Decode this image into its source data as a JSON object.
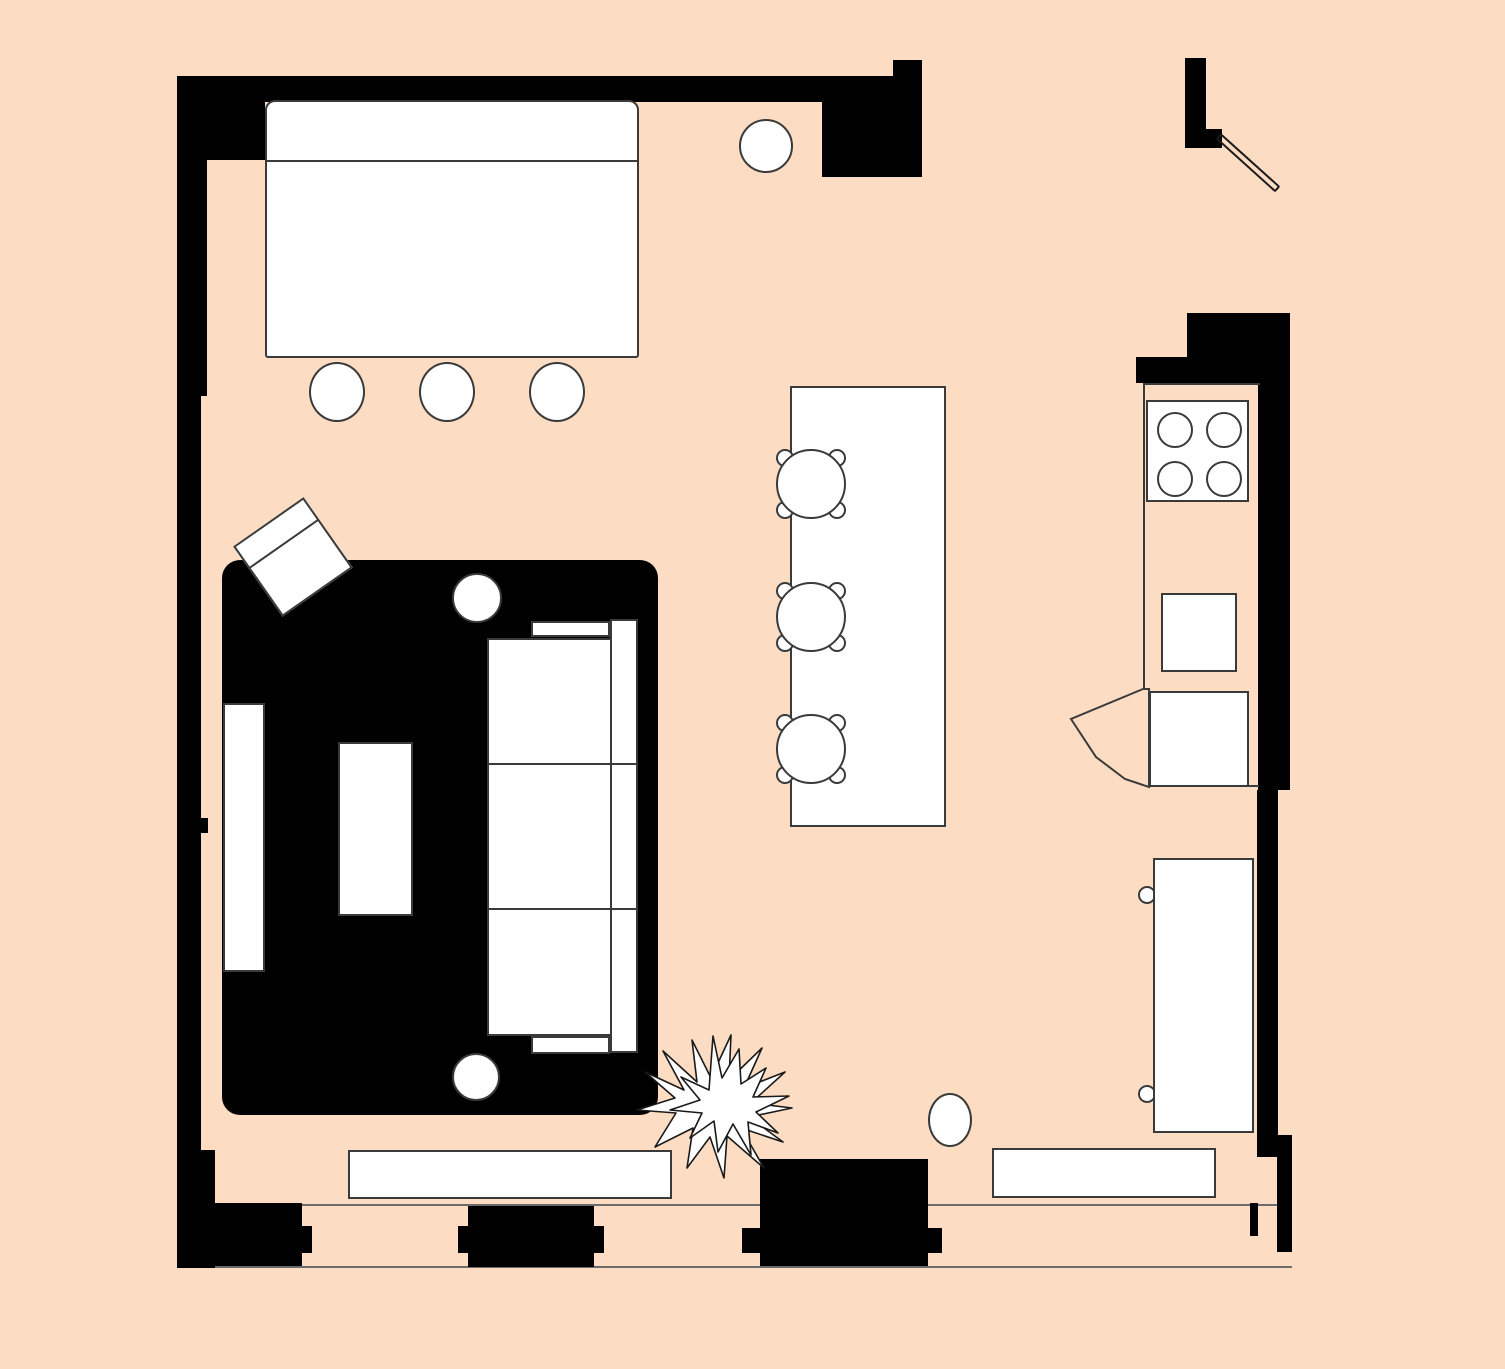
{
  "title": "Furnished studio apartment floor plan",
  "palette": {
    "background": "#fcdcc2",
    "wall": "#000000",
    "furniture_fill": "#ffffff",
    "outline": "#3a3a3a",
    "band_line": "#6b6b6b"
  },
  "inventory": {
    "dining_area": {
      "table": 1,
      "round_chairs": 4
    },
    "living_area": {
      "rug": 1,
      "sofa_seat_cushions": 3,
      "armchair": 1,
      "round_side_tables": 2,
      "coffee_tables": 2,
      "media_bench": 1,
      "plant": 1
    },
    "kitchen": {
      "island": 1,
      "bar_stools": 3,
      "stove_burners": 4,
      "counter_squares": 2,
      "fridge": 1,
      "fridge_hinges": 2,
      "bench": 1,
      "stool": 1
    },
    "openings": {
      "hinged_doors": 1,
      "window_piers": 2
    }
  }
}
